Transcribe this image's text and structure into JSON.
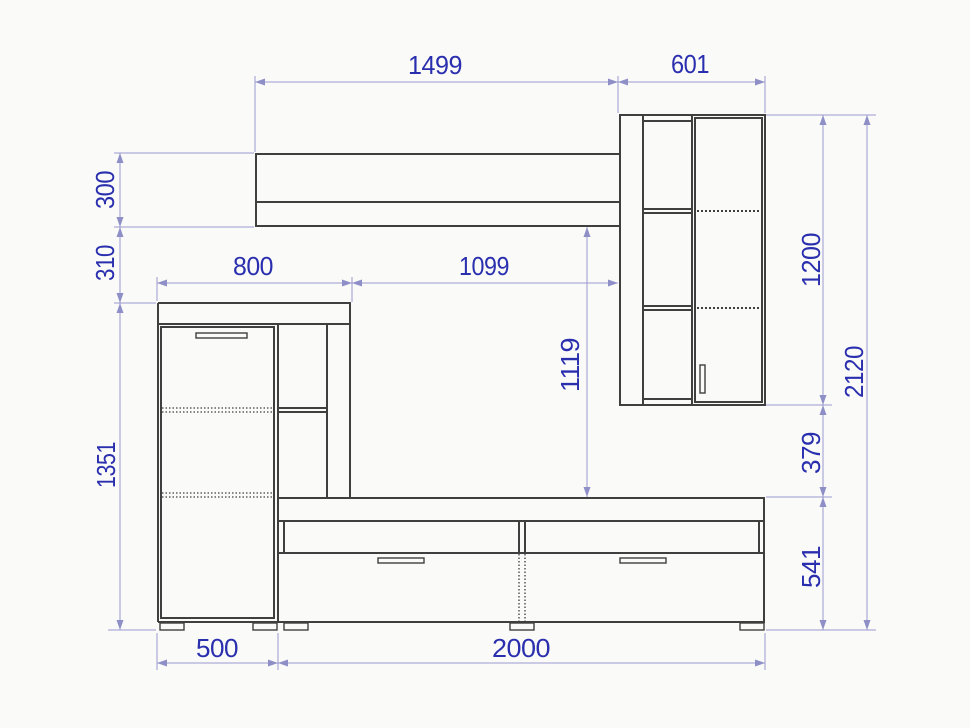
{
  "drawing": {
    "kind": "furniture wall-unit dimensioned front view",
    "units_shown": "none (mm implied)"
  },
  "colors": {
    "background": "#fafaf9",
    "furniture_line": "#3f3f3f",
    "dimension_line": "#9a9ace",
    "dimension_arrow": "#8f8fc8",
    "dimension_text": "#2a2fae"
  },
  "dims": {
    "shelf_width": "1499",
    "wall_cabinet_width": "601",
    "shelf_height": "300",
    "shelf_to_cabinet_gap": "310",
    "left_cabinet_height": "1351",
    "left_cabinet_width": "800",
    "mid_span": "1099",
    "shelf_to_stand": "1119",
    "wall_cabinet_height": "1200",
    "cabinet_to_stand_gap": "379",
    "tv_stand_height": "541",
    "total_height": "2120",
    "left_door_section_width": "500",
    "tv_stand_width": "2000"
  }
}
